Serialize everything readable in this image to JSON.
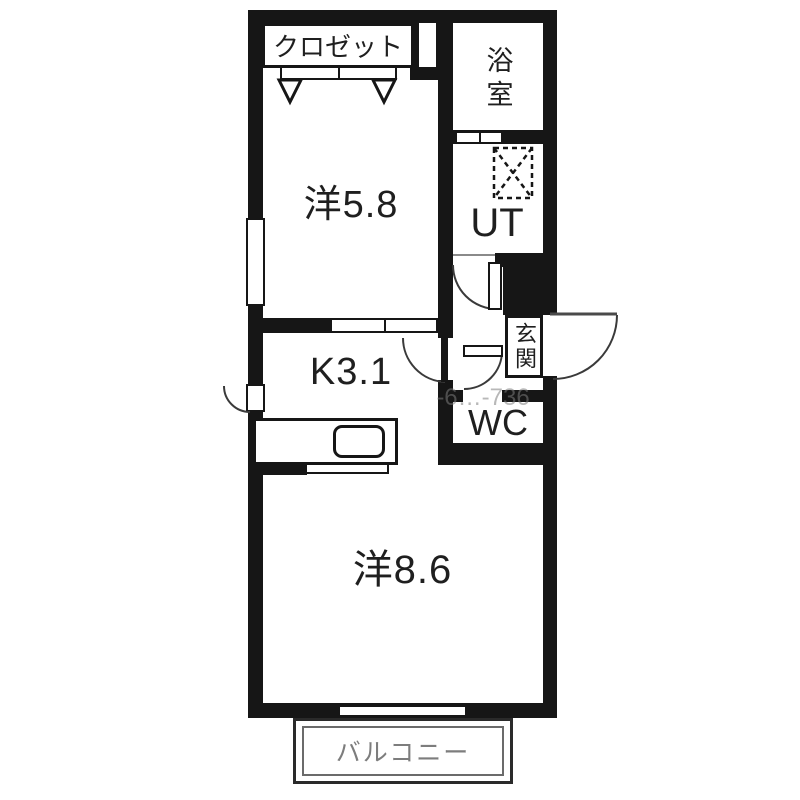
{
  "plan_title": "1K floor plan",
  "rooms": {
    "closet": {
      "label": "クロゼット"
    },
    "bath": {
      "label": "浴室"
    },
    "western58": {
      "label": "洋5.8"
    },
    "ut": {
      "label": "UT"
    },
    "kitchen": {
      "label": "K3.1"
    },
    "genkan": {
      "label": "玄関"
    },
    "wc": {
      "label": "WC"
    },
    "western86": {
      "label": "洋8.6"
    },
    "balcony": {
      "label": "バルコニー"
    }
  },
  "watermark": "-6…-736",
  "colors": {
    "wall": "#161616",
    "label_text": "#1f1f1f",
    "balcony_text": "#7d7d7d",
    "background": "#ffffff"
  }
}
